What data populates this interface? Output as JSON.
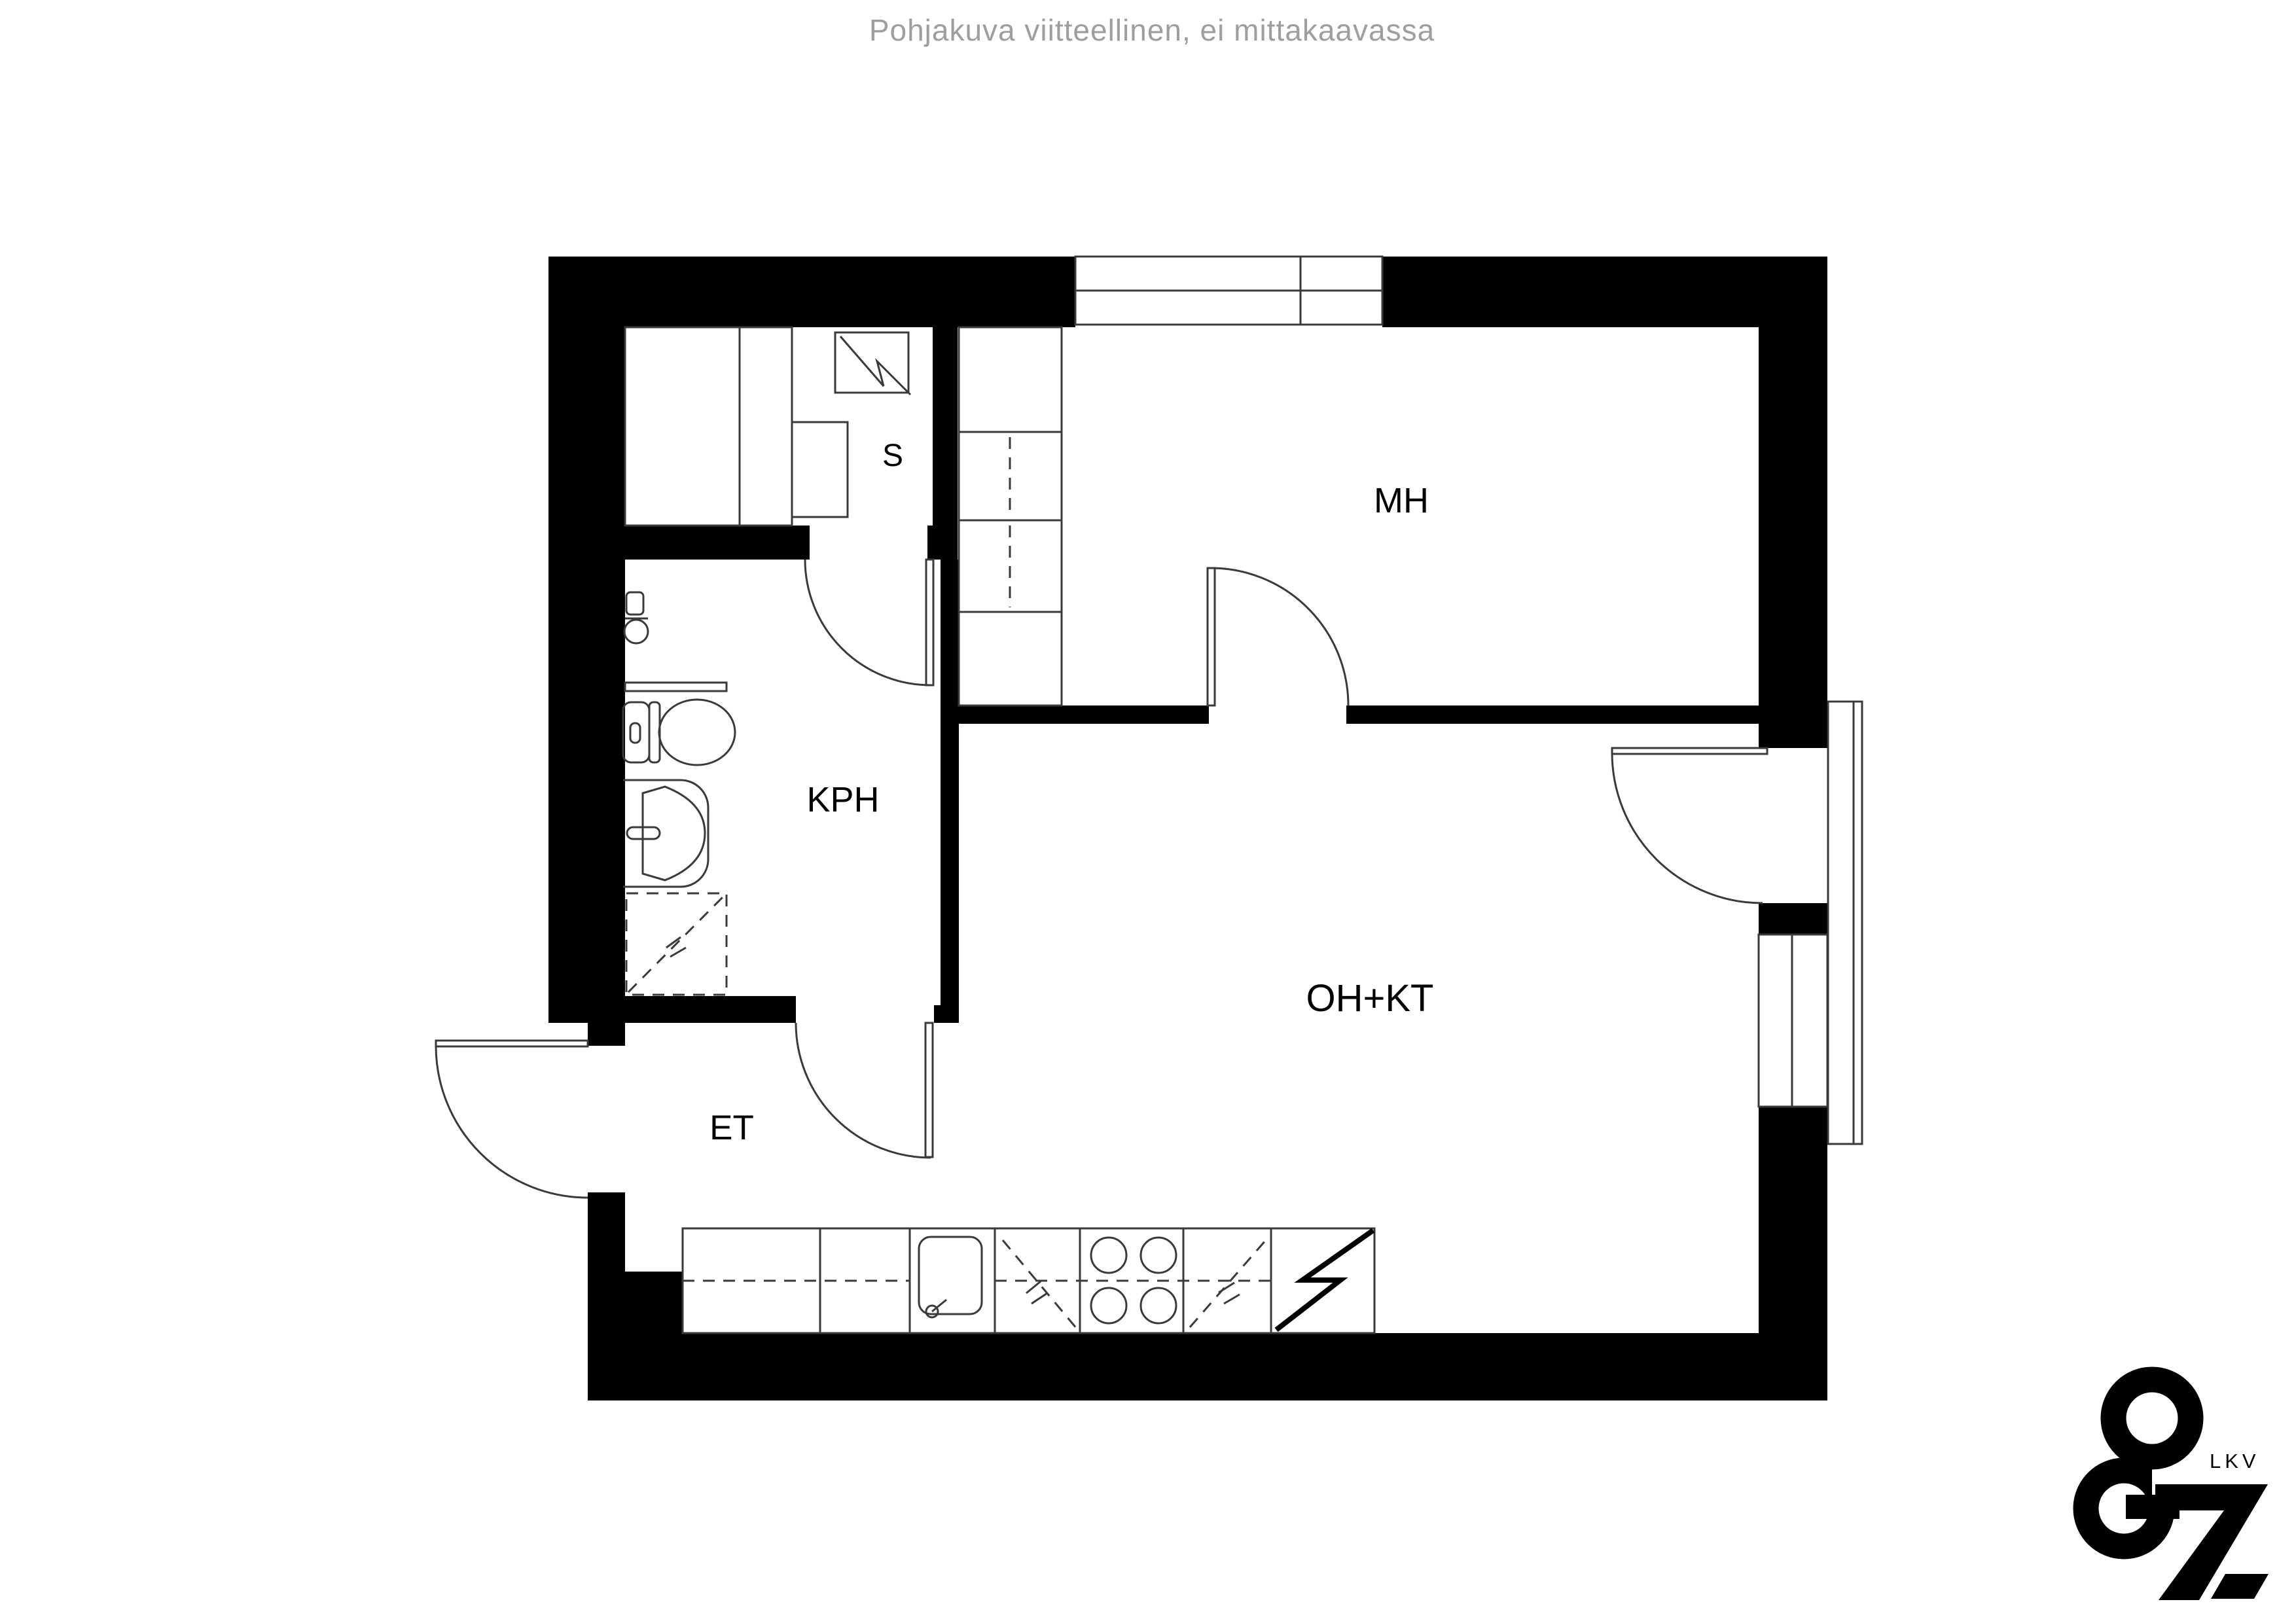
{
  "header": {
    "disclaimer": "Pohjakuva viitteellinen, ei mittakaavassa"
  },
  "rooms": [
    {
      "name": "sauna",
      "label": "S"
    },
    {
      "name": "bathroom",
      "label": "KPH"
    },
    {
      "name": "entry-hall",
      "label": "ET"
    },
    {
      "name": "bedroom",
      "label": "MH"
    },
    {
      "name": "living-room-kitchen",
      "label": "OH+KT"
    }
  ],
  "logo": {
    "text": "LKV"
  },
  "colors": {
    "wall": "#000000",
    "line": "#3a3a3a",
    "disclaimer_text": "#9e9e9e",
    "background": "#ffffff"
  }
}
